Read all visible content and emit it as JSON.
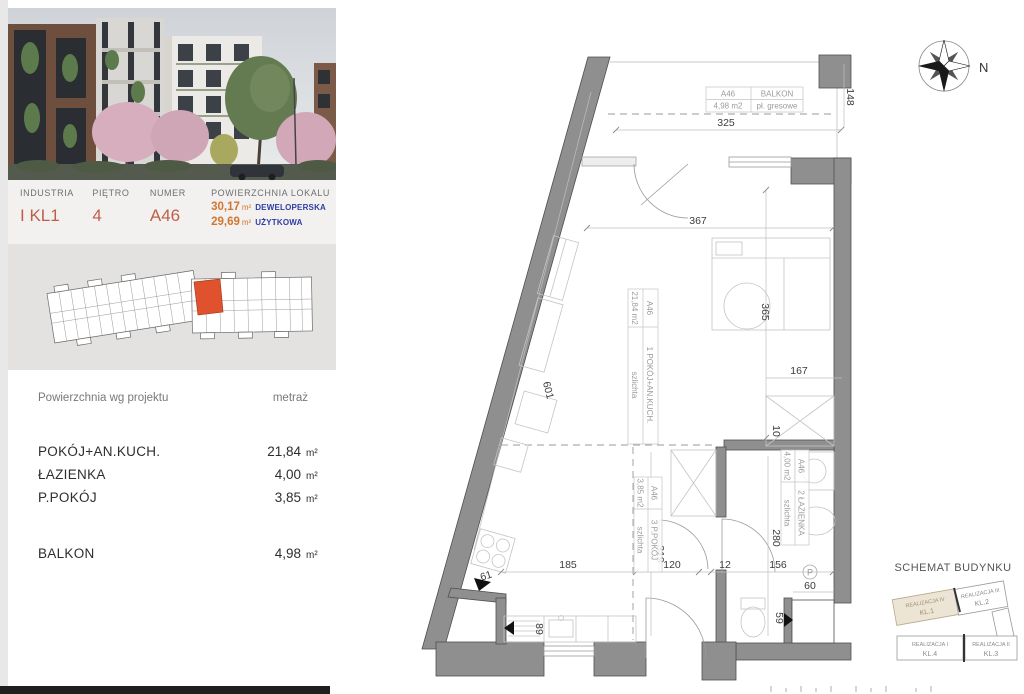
{
  "left_panel": {
    "header": {
      "col1_label": "INDUSTRIA",
      "col1_value": "I KL1",
      "col2_label": "PIĘTRO",
      "col2_value": "4",
      "col3_label": "NUMER",
      "col3_value": "A46",
      "col4_label": "POWIERZCHNIA LOKALU",
      "area1_value": "30,17",
      "area1_unit": "m²",
      "area1_label": "DEWELOPERSKA",
      "area2_value": "29,69",
      "area2_unit": "m²",
      "area2_label": "UŻYTKOWA"
    },
    "table": {
      "header_left": "Powierzchnia wg projektu",
      "header_right": "metraż",
      "rows": [
        {
          "label": "POKÓJ+AN.KUCH.",
          "value": "21,84",
          "unit": "m²"
        },
        {
          "label": "ŁAZIENKA",
          "value": "4,00",
          "unit": "m²"
        },
        {
          "label": "P.POKÓJ",
          "value": "3,85",
          "unit": "m²"
        }
      ],
      "balcony_row": {
        "label": "BALKON",
        "value": "4,98",
        "unit": "m²"
      }
    }
  },
  "plan": {
    "compass_label": "N",
    "balcony_table": {
      "id": "A46",
      "name": "BALKON",
      "area": "4,98 m2",
      "floor": "pł. gresowe"
    },
    "room_main": {
      "id": "A46",
      "area": "21,84 m2",
      "name": "1 POKÓJ+AN.KUCH.",
      "floor": "szlichta"
    },
    "room_bath": {
      "id": "A46",
      "area": "4,00 m2",
      "name": "2 ŁAZIENKA",
      "floor": "szlichta"
    },
    "room_hall": {
      "id": "A46",
      "area": "3,85 m2",
      "name": "3 P.POKÓJ",
      "floor": "szlichta"
    },
    "dims": {
      "d325": "325",
      "d148": "148",
      "d367": "367",
      "d365": "365",
      "d167": "167",
      "d10": "10",
      "d601": "601",
      "d61": "61",
      "d185": "185",
      "d89": "89",
      "d319": "319",
      "d120": "120",
      "d12": "12",
      "d156": "156",
      "d280": "280",
      "d60": "60",
      "d59": "59",
      "shaft_symbol": "P"
    }
  },
  "schema": {
    "title": "SCHEMAT BUDYNKU",
    "blocks": [
      {
        "line1": "REALIZACJA IV",
        "line2": "KL.1"
      },
      {
        "line1": "REALIZACJA III",
        "line2": "KL.2"
      },
      {
        "line1": "REALIZACJA I",
        "line2": "KL.4"
      },
      {
        "line1": "REALIZACJA II",
        "line2": "KL.3"
      }
    ]
  },
  "colors": {
    "accent_red": "#e0512e",
    "wall_gray": "#8f8f8f",
    "value_orange": "#bd5f48",
    "num_orange": "#d2762f",
    "label_blue": "#2f3da1"
  }
}
